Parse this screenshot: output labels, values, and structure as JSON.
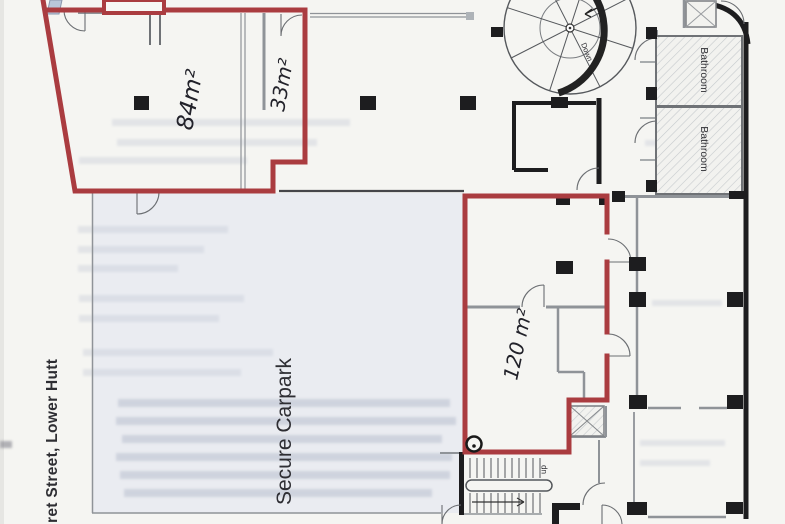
{
  "plan": {
    "labels": {
      "street": "ret Street, Lower Hutt",
      "carpark": "Secure Carpark",
      "area_84": "84m²",
      "area_33": "33m²",
      "area_120": "120 m²",
      "bathroom_upper": "Bathroom",
      "bathroom_lower": "Bathroom",
      "spiral_direction": "Down",
      "stair_direction": "up"
    },
    "colors": {
      "premises_outline_red": "#aa3c40",
      "wall_black": "#1d1d1f",
      "wall_grey": "#8f9398",
      "carpark_tint": "#eaecf1",
      "page_background": "#f5f5f2",
      "ghost_text_grey": "#bdc3d2",
      "shading_blue_grey": "#b9c6da"
    }
  }
}
